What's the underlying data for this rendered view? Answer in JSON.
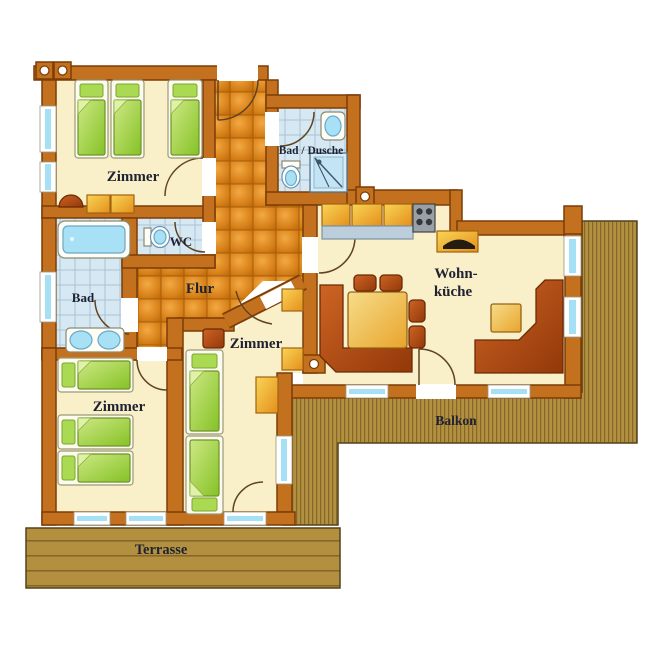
{
  "rooms": {
    "zimmer_top": {
      "label": "Zimmer"
    },
    "bad_dusche": {
      "label": "Bad / Dusche"
    },
    "wc": {
      "label": "WC"
    },
    "flur": {
      "label": "Flur"
    },
    "bad": {
      "label": "Bad"
    },
    "wohnkueche": {
      "label_line1": "Wohn-",
      "label_line2": "küche"
    },
    "zimmer_left": {
      "label": "Zimmer"
    },
    "zimmer_middle": {
      "label": "Zimmer"
    },
    "balkon": {
      "label": "Balkon"
    },
    "terrasse": {
      "label": "Terrasse"
    }
  },
  "colors": {
    "wall": "#c4711f",
    "wall_outline": "#7c3d07",
    "room_floor": "#f9efc8",
    "hall_tile": "#d8821a",
    "bath_tile": "#d6e9f3",
    "wood_deck": "#b3903f",
    "window_glass": "#a6e0f5",
    "bed_green": "#8fc832",
    "furniture_gold": "#edaa28",
    "furniture_rust": "#b34f16",
    "label_text": "#1e2233"
  }
}
